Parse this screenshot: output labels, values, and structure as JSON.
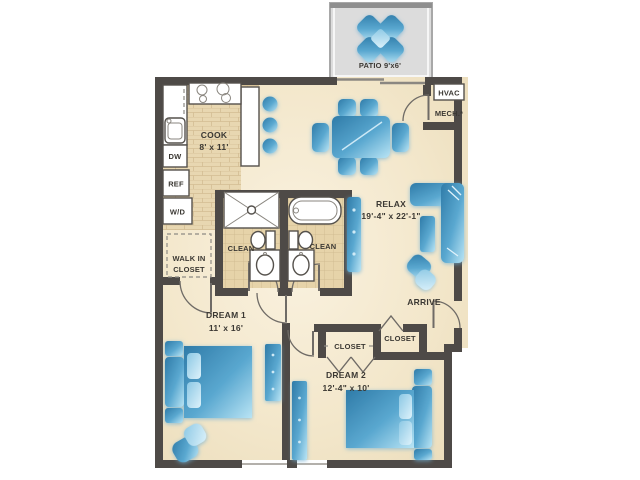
{
  "colors": {
    "wall": "#4e4a47",
    "arc_stroke": "#6f6b66",
    "fixture_stroke": "#55514c",
    "patio_floor": "#dcdcdc",
    "patio_border": "#a8a8a8",
    "kitchen_tile": "#e8d7b1",
    "bath_tile": "#e6d3a9",
    "grout": "#d3bd93",
    "floor_mid": "#f3e7cb",
    "furniture_dark": "#2f7ba8",
    "furniture_light": "#abdcf0"
  },
  "rooms": {
    "patio": {
      "label": "PATIO 9'x6'"
    },
    "kitchen": {
      "name": "COOK",
      "dims": "8' x 11'"
    },
    "living": {
      "name": "RELAX",
      "dims": "19'-4\" x 22'-1\""
    },
    "mech": {
      "unit": "HVAC",
      "label": "MECH.*"
    },
    "bath1": {
      "label": "CLEAN"
    },
    "bath2": {
      "label": "CLEAN"
    },
    "walk_in_closet": {
      "line1": "WALK IN",
      "line2": "CLOSET"
    },
    "bedroom1": {
      "name": "DREAM 1",
      "dims": "11' x 16'"
    },
    "bedroom2": {
      "name": "DREAM 2",
      "dims": "12'-4\" x 10'"
    },
    "closet_bedroom2": {
      "label": "CLOSET"
    },
    "closet_entry": {
      "label": "CLOSET"
    },
    "entry": {
      "label": "ARRIVE"
    },
    "appliances": {
      "dishwasher": "DW",
      "refrigerator": "REF",
      "washer_dryer": "W/D"
    }
  }
}
